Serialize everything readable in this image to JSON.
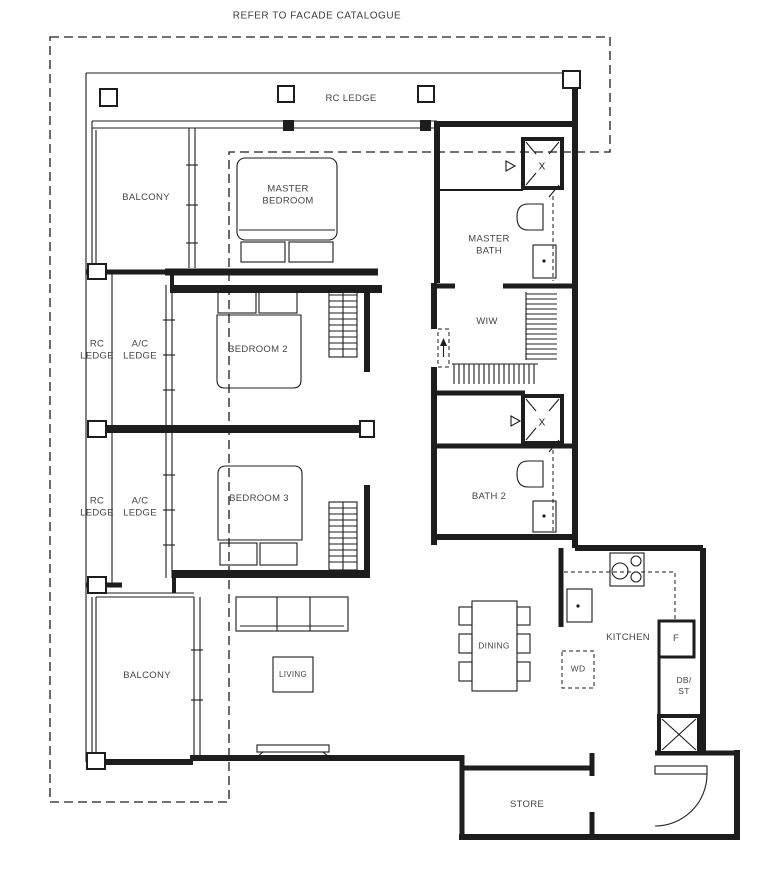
{
  "header": {
    "note": "REFER TO FACADE CATALOGUE"
  },
  "labels": {
    "rc_ledge_top": "RC LEDGE",
    "balcony_top": "BALCONY",
    "master_bedroom": "MASTER\nBEDROOM",
    "master_bath": "MASTER\nBATH",
    "wiw": "WIW",
    "rc_ledge_upper": "RC\nLEDGE",
    "ac_ledge_upper": "A/C\nLEDGE",
    "bedroom2": "BEDROOM 2",
    "rc_ledge_lower": "RC\nLEDGE",
    "ac_ledge_lower": "A/C\nLEDGE",
    "bedroom3": "BEDROOM 3",
    "bath2": "BATH 2",
    "balcony_bottom": "BALCONY",
    "living": "LIVING",
    "dining": "DINING",
    "kitchen": "KITCHEN",
    "wd": "WD",
    "fridge": "F",
    "db_st": "DB/\nST",
    "store": "STORE",
    "shaft": "X"
  },
  "colors": {
    "line": "#1d1d1d",
    "text": "#454545",
    "background": "#ffffff"
  }
}
